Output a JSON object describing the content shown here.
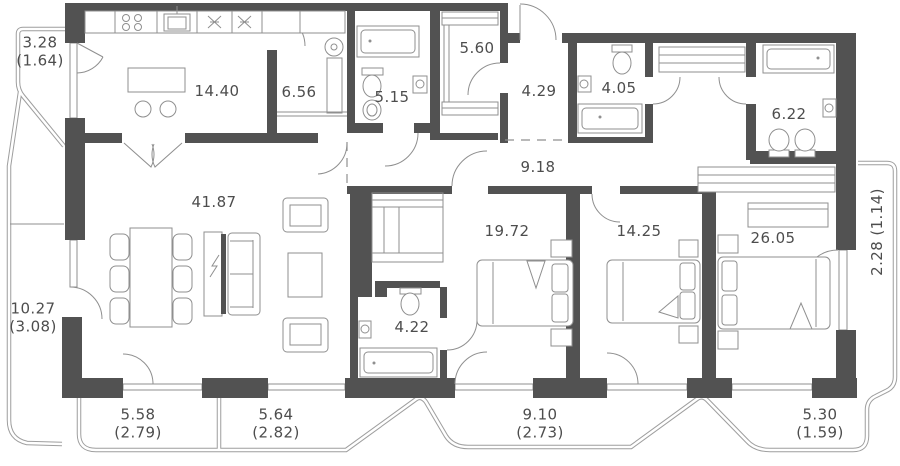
{
  "theme": {
    "wall": "#525252",
    "line": "#8f8f8f",
    "line_light": "#9e9e9e",
    "text": "#4d4d4d",
    "bg": "#ffffff"
  },
  "rooms": [
    {
      "key": "kitchen",
      "area": "14.40"
    },
    {
      "key": "pantry",
      "area": "6.56"
    },
    {
      "key": "bathroom-1",
      "area": "5.15"
    },
    {
      "key": "wardrobe",
      "area": "5.60"
    },
    {
      "key": "hallway",
      "area": "4.29"
    },
    {
      "key": "bathroom-2",
      "area": "4.05"
    },
    {
      "key": "bathroom-3",
      "area": "6.22"
    },
    {
      "key": "corridor",
      "area": "9.18"
    },
    {
      "key": "living-room",
      "area": "41.87"
    },
    {
      "key": "bedroom-1",
      "area": "19.72"
    },
    {
      "key": "bedroom-2",
      "area": "14.25"
    },
    {
      "key": "bedroom-3",
      "area": "26.05"
    },
    {
      "key": "bathroom-4",
      "area": "4.22"
    }
  ],
  "balconies": [
    {
      "key": "top-left",
      "area": "3.28",
      "reduced": "(1.64)"
    },
    {
      "key": "left",
      "area": "10.27",
      "reduced": "(3.08)"
    },
    {
      "key": "bottom-1",
      "area": "5.58",
      "reduced": "(2.79)"
    },
    {
      "key": "bottom-2",
      "area": "5.64",
      "reduced": "(2.82)"
    },
    {
      "key": "bottom-3",
      "area": "9.10",
      "reduced": "(2.73)"
    },
    {
      "key": "bottom-4",
      "area": "5.30",
      "reduced": "(1.59)"
    },
    {
      "key": "right",
      "area": "2.28 (1.14)",
      "reduced": ""
    }
  ]
}
